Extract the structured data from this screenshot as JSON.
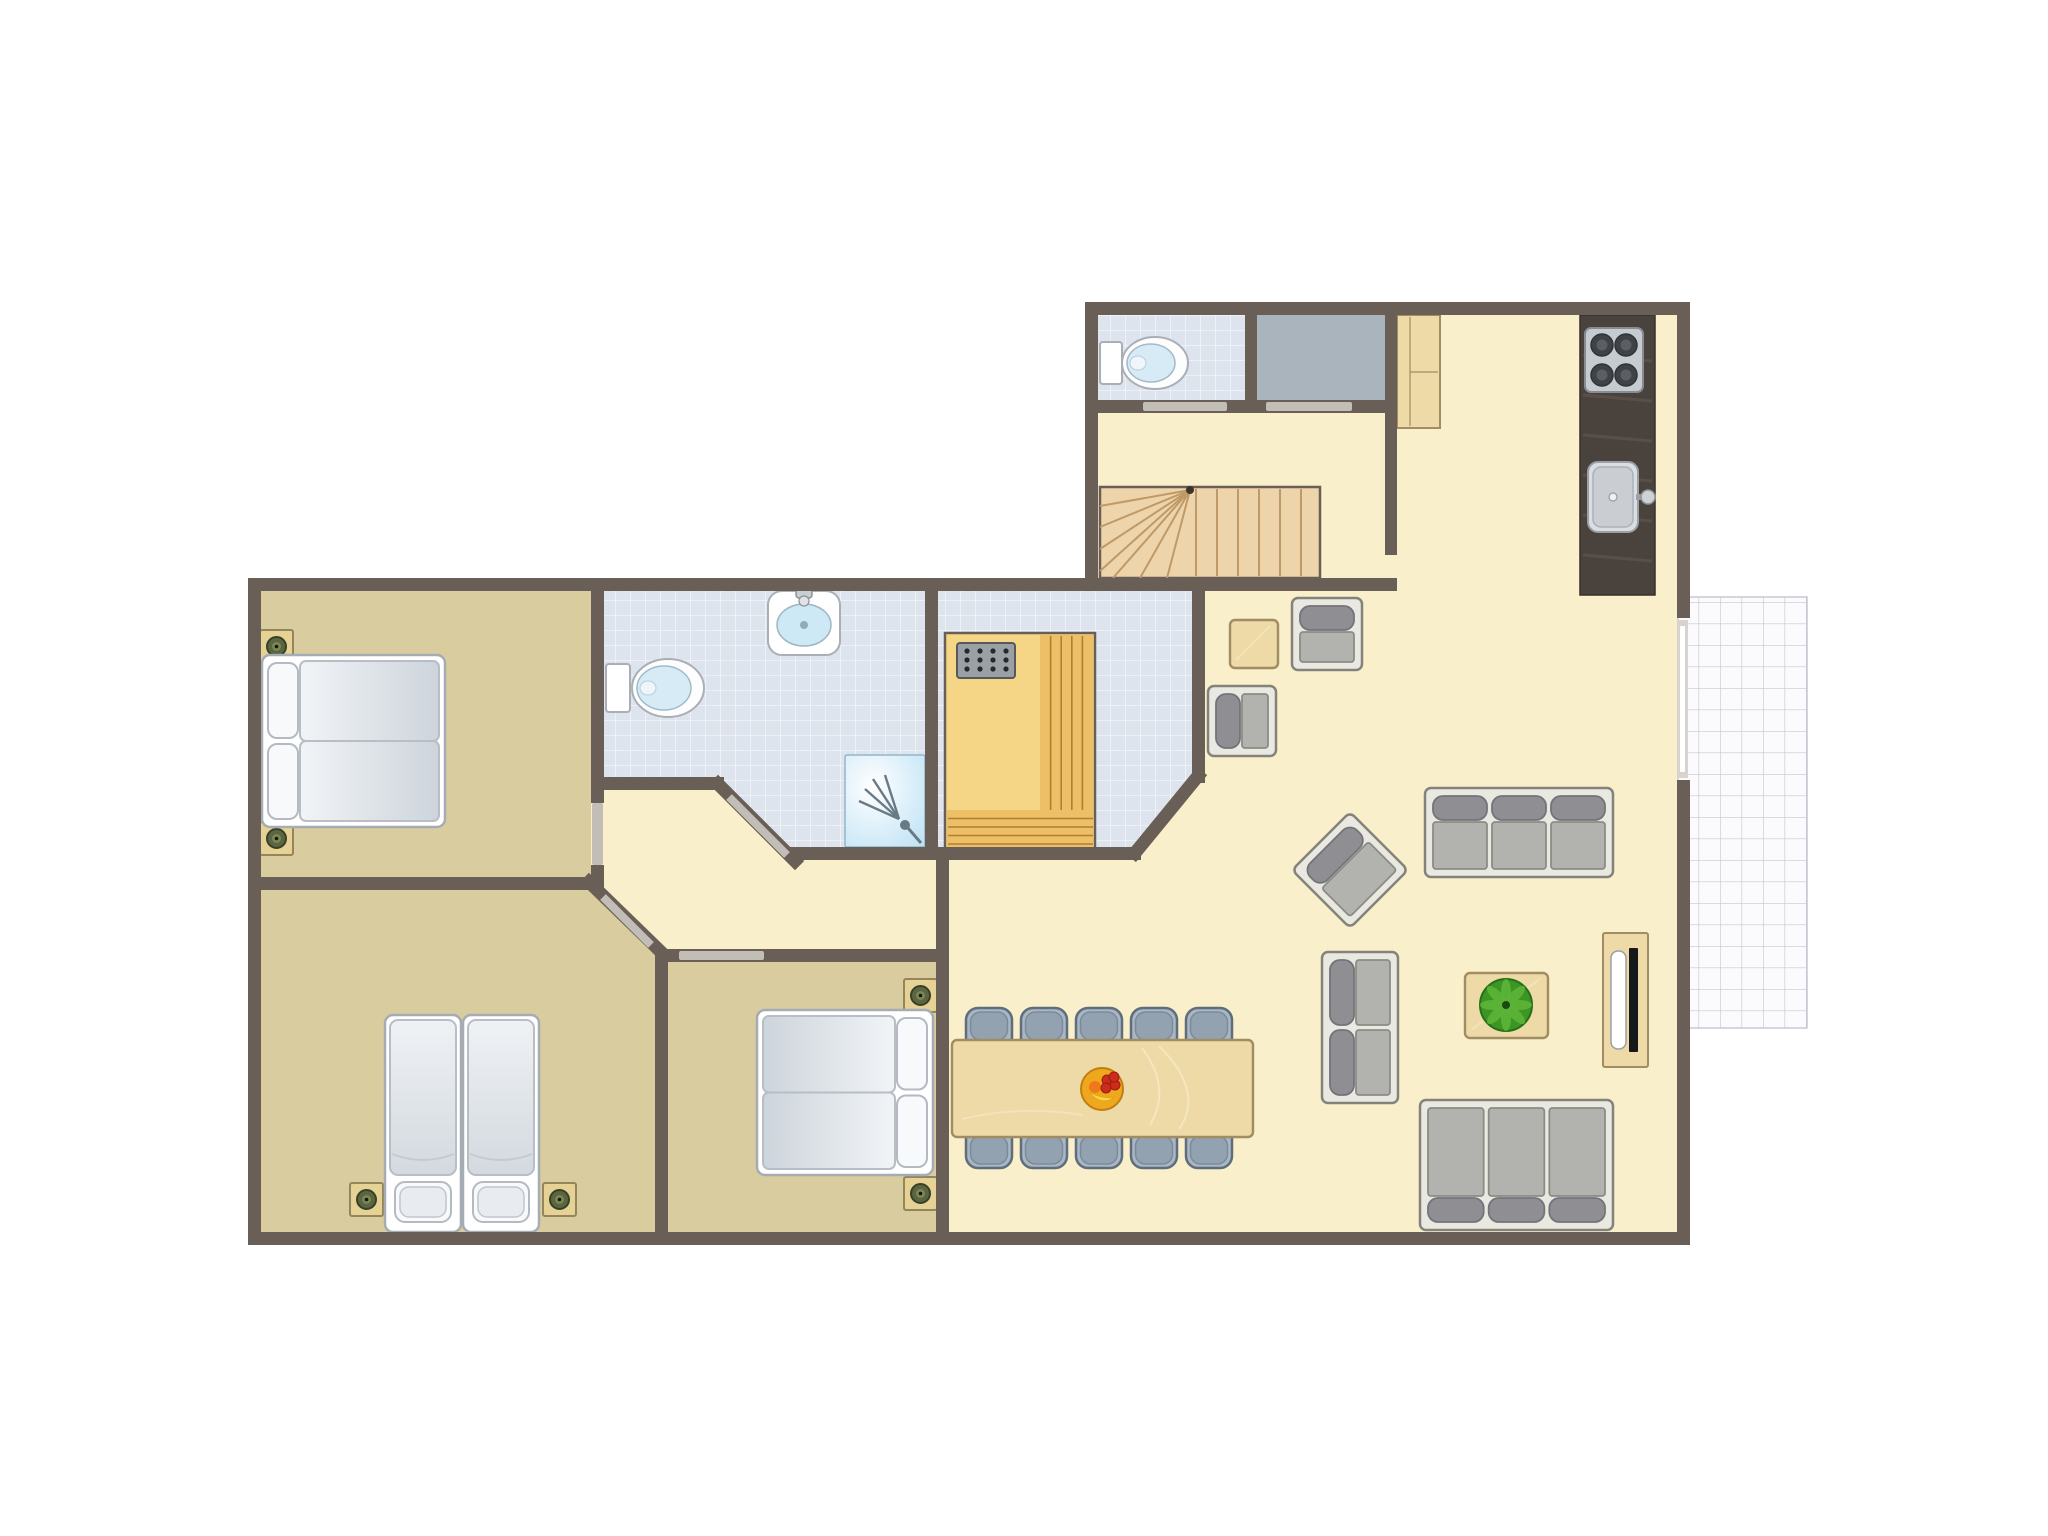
{
  "plan": {
    "canvas": {
      "w": 2048,
      "h": 1536
    },
    "palette": {
      "wall": "#6a5f57",
      "floor": "#f9efca",
      "bedroom": "#d9cda0",
      "tile": "#dee4ee",
      "storage": "#a9b4bc",
      "terrace": "#fbfbfd",
      "wood": "#eedaa6",
      "woodBorder": "#a08d64",
      "stairWood": "#eed4ab",
      "stairLine": "#bf9a67",
      "counter": "#4a423c",
      "counterLine": "#5c534b",
      "saunaWood": "#f4d686",
      "saunaBench": "#edbf66",
      "saunaLine": "#b07f33",
      "chairFill": "#a9b6c4",
      "chairStroke": "#5f6d7c",
      "chairCap": "#93a2b1",
      "doorBar": "#c3bdb7",
      "bedStroke": "#a6acb4",
      "pillow": "#f7f9fa",
      "sofaFrame": "#e9e9e2",
      "sofaStroke": "#83837b",
      "sofaSeat": "#b2b2ae",
      "sofaSeatStroke": "#8c8c86",
      "sofaPill": "#8f8f93",
      "sofaPillStroke": "#73737a",
      "shower": "#bfe5f7",
      "waterBlue": "#cde9f6"
    },
    "rooms": [
      {
        "name": "bedroom-1"
      },
      {
        "name": "bedroom-2"
      },
      {
        "name": "bedroom-3"
      },
      {
        "name": "bathroom"
      },
      {
        "name": "sauna-room"
      },
      {
        "name": "wc"
      },
      {
        "name": "storage"
      },
      {
        "name": "stair-hall"
      },
      {
        "name": "kitchen"
      },
      {
        "name": "living-dining"
      },
      {
        "name": "hall"
      },
      {
        "name": "terrace"
      }
    ],
    "layers": [
      {
        "t": "terrace",
        "name": "terrace",
        "x": 1678,
        "y": 597,
        "w": 129,
        "h": 431
      },
      {
        "t": "poly",
        "name": "floor-main",
        "points": "261,591 1098,591 1098,315 1677,315 1677,1232 261,1232",
        "fill": "floor"
      },
      {
        "t": "rect",
        "name": "floor-bedroom-1",
        "x": 261,
        "y": 591,
        "w": 330,
        "h": 286,
        "fill": "bedroom"
      },
      {
        "t": "poly",
        "name": "floor-bedroom-2",
        "points": "261,890 590,890 655,950 655,1232 261,1232",
        "fill": "bedroom"
      },
      {
        "t": "rect",
        "name": "floor-bedroom-3",
        "x": 668,
        "y": 962,
        "w": 268,
        "h": 270,
        "fill": "bedroom"
      },
      {
        "t": "tilepoly",
        "name": "floor-bathroom",
        "points": "604,591 925,591 925,847 786,847 724,784 604,784"
      },
      {
        "t": "tilepoly",
        "name": "floor-sauna-room",
        "points": "938,591 1192,591 1192,777 1135,847 938,847"
      },
      {
        "t": "tilerect",
        "name": "floor-wc",
        "x": 1098,
        "y": 315,
        "w": 147,
        "h": 85
      },
      {
        "t": "rect",
        "name": "floor-storage",
        "x": 1257,
        "y": 315,
        "w": 128,
        "h": 85,
        "fill": "storage"
      },
      {
        "t": "shower",
        "name": "shower",
        "x": 845,
        "y": 755,
        "w": 80,
        "h": 92
      },
      {
        "t": "stairs",
        "name": "stairs",
        "x": 1100,
        "y": 487,
        "w": 220,
        "h": 91,
        "apex": [
          1190,
          490
        ],
        "treads": [
          1196,
          1217,
          1238,
          1259,
          1280,
          1301
        ],
        "fan": [
          [
            1100,
            506
          ],
          [
            1100,
            527
          ],
          [
            1100,
            549
          ],
          [
            1100,
            571
          ],
          [
            1113,
            578
          ],
          [
            1140,
            578
          ],
          [
            1167,
            578
          ]
        ]
      },
      {
        "t": "sauna",
        "name": "sauna-cabin",
        "x": 945,
        "y": 633,
        "w": 150,
        "h": 217
      },
      {
        "t": "counter",
        "name": "kitchen-counter",
        "x": 1580,
        "y": 315,
        "w": 75,
        "h": 280
      },
      {
        "t": "stove",
        "name": "stove",
        "x": 1585,
        "y": 328,
        "w": 58,
        "h": 64
      },
      {
        "t": "sink",
        "name": "kitchen-sink",
        "x": 1588,
        "y": 462,
        "w": 50,
        "h": 70
      },
      {
        "t": "cabinet",
        "name": "kitchen-cabinet",
        "x": 1397,
        "y": 315,
        "w": 43,
        "h": 113
      },
      {
        "t": "toilet",
        "name": "toilet-wc",
        "tank": [
          1100,
          342,
          22,
          42
        ],
        "bowl": [
          1155,
          363,
          33,
          26
        ]
      },
      {
        "t": "toilet",
        "name": "toilet-bathroom",
        "tank": [
          606,
          664,
          24,
          48
        ],
        "bowl": [
          668,
          688,
          36,
          29
        ]
      },
      {
        "t": "basin",
        "name": "washbasin",
        "x": 768,
        "y": 591,
        "w": 72,
        "h": 64
      },
      {
        "t": "nightstand",
        "name": "nightstand",
        "x": 260,
        "y": 630
      },
      {
        "t": "nightstand",
        "name": "nightstand",
        "x": 260,
        "y": 822
      },
      {
        "t": "bedDouble",
        "name": "double-bed-bedroom-1",
        "x": 262,
        "y": 655,
        "w": 183,
        "h": 172,
        "head": "left"
      },
      {
        "t": "nightstand",
        "name": "nightstand",
        "x": 350,
        "y": 1183
      },
      {
        "t": "nightstand",
        "name": "nightstand",
        "x": 543,
        "y": 1183
      },
      {
        "t": "bedSingle",
        "name": "single-bed-left",
        "x": 385,
        "y": 1015,
        "w": 76,
        "h": 217
      },
      {
        "t": "bedSingle",
        "name": "single-bed-right",
        "x": 463,
        "y": 1015,
        "w": 76,
        "h": 217
      },
      {
        "t": "nightstand",
        "name": "nightstand",
        "x": 904,
        "y": 979
      },
      {
        "t": "nightstand",
        "name": "nightstand",
        "x": 904,
        "y": 1177
      },
      {
        "t": "bedDouble",
        "name": "double-bed-bedroom-3",
        "x": 757,
        "y": 1010,
        "w": 176,
        "h": 165,
        "head": "right"
      },
      {
        "t": "woodtable",
        "name": "side-table",
        "x": 1230,
        "y": 620,
        "w": 48,
        "h": 48
      },
      {
        "t": "armchair",
        "name": "armchair",
        "x": 1292,
        "y": 598,
        "w": 70,
        "h": 72,
        "side": "top"
      },
      {
        "t": "armchair",
        "name": "armchair",
        "x": 1208,
        "y": 686,
        "w": 68,
        "h": 70,
        "side": "left"
      },
      {
        "t": "armchair",
        "name": "armchair",
        "x": 1309,
        "y": 829,
        "w": 82,
        "h": 82,
        "side": "top",
        "rot": -45
      },
      {
        "t": "sofa",
        "name": "sofa-3-seat-top",
        "x": 1425,
        "y": 788,
        "w": 188,
        "h": 89,
        "side": "top",
        "seats": 3
      },
      {
        "t": "sofa",
        "name": "sofa-2-seat",
        "x": 1322,
        "y": 952,
        "w": 76,
        "h": 151,
        "side": "left",
        "seats": 2
      },
      {
        "t": "sofa",
        "name": "sofa-3-seat-bottom",
        "x": 1420,
        "y": 1100,
        "w": 193,
        "h": 130,
        "side": "bottom",
        "seats": 3
      },
      {
        "t": "woodtable",
        "name": "coffee-table",
        "x": 1465,
        "y": 973,
        "w": 83,
        "h": 65
      },
      {
        "t": "plant",
        "name": "potted-plant",
        "cx": 1506,
        "cy": 1005,
        "r": 26
      },
      {
        "t": "tvboard",
        "name": "tv-sideboard",
        "x": 1603,
        "y": 933,
        "w": 45,
        "h": 134
      },
      {
        "t": "chair",
        "name": "dining-chair",
        "x": 966,
        "y": 1008,
        "w": 46,
        "h": 64,
        "cap": "top"
      },
      {
        "t": "chair",
        "name": "dining-chair",
        "x": 1021,
        "y": 1008,
        "w": 46,
        "h": 64,
        "cap": "top"
      },
      {
        "t": "chair",
        "name": "dining-chair",
        "x": 1076,
        "y": 1008,
        "w": 46,
        "h": 64,
        "cap": "top"
      },
      {
        "t": "chair",
        "name": "dining-chair",
        "x": 1131,
        "y": 1008,
        "w": 46,
        "h": 64,
        "cap": "top"
      },
      {
        "t": "chair",
        "name": "dining-chair",
        "x": 1186,
        "y": 1008,
        "w": 46,
        "h": 64,
        "cap": "top"
      },
      {
        "t": "chair",
        "name": "dining-chair",
        "x": 966,
        "y": 1104,
        "w": 46,
        "h": 64,
        "cap": "bottom"
      },
      {
        "t": "chair",
        "name": "dining-chair",
        "x": 1021,
        "y": 1104,
        "w": 46,
        "h": 64,
        "cap": "bottom"
      },
      {
        "t": "chair",
        "name": "dining-chair",
        "x": 1076,
        "y": 1104,
        "w": 46,
        "h": 64,
        "cap": "bottom"
      },
      {
        "t": "chair",
        "name": "dining-chair",
        "x": 1131,
        "y": 1104,
        "w": 46,
        "h": 64,
        "cap": "bottom"
      },
      {
        "t": "chair",
        "name": "dining-chair",
        "x": 1186,
        "y": 1104,
        "w": 46,
        "h": 64,
        "cap": "bottom"
      },
      {
        "t": "woodtable",
        "name": "dining-table",
        "x": 952,
        "y": 1040,
        "w": 301,
        "h": 97,
        "grain": true
      },
      {
        "t": "fruit",
        "name": "fruit-bowl",
        "cx": 1102,
        "cy": 1089
      },
      {
        "t": "walls",
        "name": "walls",
        "segs": [
          [
            1085,
            302,
            605,
            13
          ],
          [
            1085,
            302,
            13,
            289
          ],
          [
            248,
            578,
            850,
            13
          ],
          [
            1085,
            578,
            312,
            13
          ],
          [
            248,
            578,
            13,
            667
          ],
          [
            248,
            1232,
            1442,
            13
          ],
          [
            1677,
            302,
            13,
            316
          ],
          [
            1677,
            780,
            13,
            465
          ],
          [
            1098,
            400,
            299,
            13
          ],
          [
            1245,
            315,
            12,
            98
          ],
          [
            1385,
            315,
            12,
            240
          ],
          [
            591,
            578,
            13,
            225
          ],
          [
            591,
            865,
            13,
            25
          ],
          [
            248,
            877,
            356,
            13
          ],
          [
            604,
            777,
            120,
            13
          ],
          [
            925,
            578,
            13,
            282
          ],
          [
            786,
            847,
            355,
            13
          ],
          [
            1192,
            578,
            13,
            205
          ],
          [
            936,
            853,
            13,
            392
          ],
          [
            660,
            949,
            288,
            13
          ],
          [
            655,
            949,
            13,
            296
          ]
        ],
        "diag": [
          [
            589,
            882,
            659,
            950
          ],
          [
            718,
            784,
            795,
            861
          ],
          [
            1135,
            853,
            1198,
            776
          ]
        ]
      },
      {
        "t": "doors",
        "name": "door-marks",
        "bars": [
          [
            1143,
            402,
            84,
            9
          ],
          [
            1266,
            402,
            86,
            9
          ],
          [
            679,
            951,
            85,
            9
          ],
          [
            592,
            803,
            11,
            62
          ]
        ],
        "diag": [
          [
            729,
            797,
            787,
            855
          ],
          [
            603,
            897,
            651,
            945
          ]
        ],
        "sliderOuter": [
          1677,
          620,
          11,
          158
        ],
        "sliderInner": [
          1680,
          626,
          5,
          146
        ]
      }
    ]
  }
}
